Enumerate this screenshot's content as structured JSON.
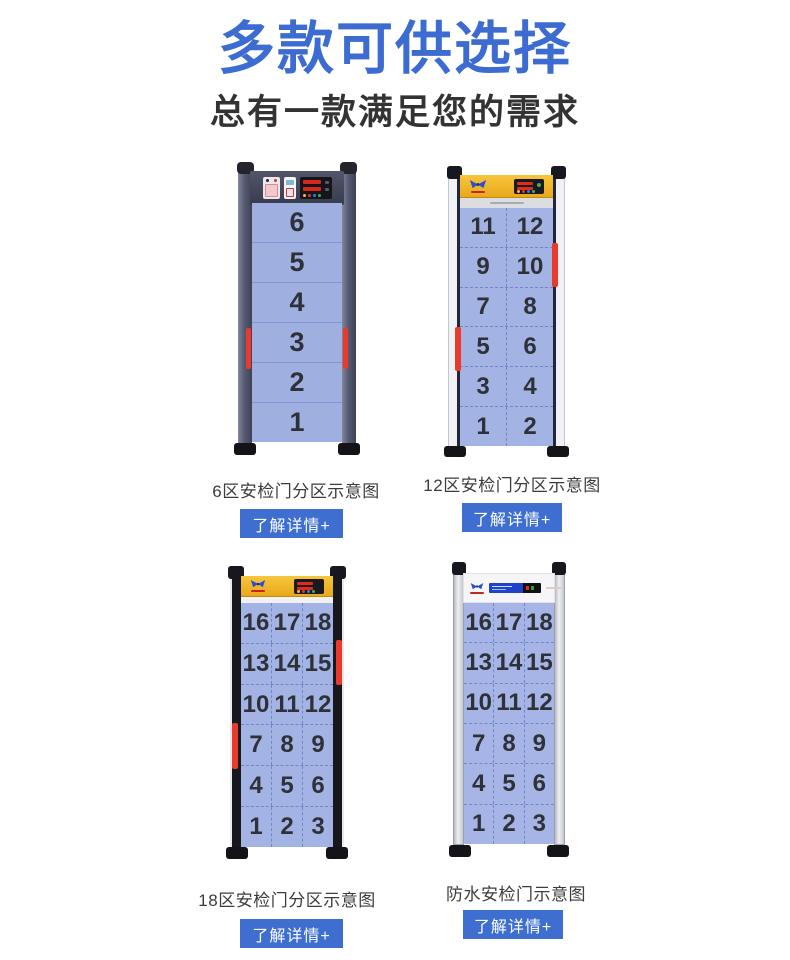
{
  "header": {
    "title": "多款可供选择",
    "subtitle": "总有一款满足您的需求"
  },
  "colors": {
    "accent_blue": "#3c6bd2",
    "button_blue": "#3e6fd0",
    "panel_blue": "#a3b3e4",
    "alarm_red": "#e93a2c",
    "header_yellow": "#eeb224"
  },
  "products": [
    {
      "id": "6-zone",
      "caption": "6区安检门分区示意图",
      "button_label": "了解详情+",
      "zone_rows": [
        [
          "6"
        ],
        [
          "5"
        ],
        [
          "4"
        ],
        [
          "3"
        ],
        [
          "2"
        ],
        [
          "1"
        ]
      ]
    },
    {
      "id": "12-zone",
      "caption": "12区安检门分区示意图",
      "button_label": "了解详情+",
      "zone_rows": [
        [
          "11",
          "12"
        ],
        [
          "9",
          "10"
        ],
        [
          "7",
          "8"
        ],
        [
          "5",
          "6"
        ],
        [
          "3",
          "4"
        ],
        [
          "1",
          "2"
        ]
      ]
    },
    {
      "id": "18-zone",
      "caption": "18区安检门分区示意图",
      "button_label": "了解详情+",
      "zone_rows": [
        [
          "16",
          "17",
          "18"
        ],
        [
          "13",
          "14",
          "15"
        ],
        [
          "10",
          "11",
          "12"
        ],
        [
          "7",
          "8",
          "9"
        ],
        [
          "4",
          "5",
          "6"
        ],
        [
          "1",
          "2",
          "3"
        ]
      ]
    },
    {
      "id": "waterproof",
      "caption": "防水安检门示意图",
      "button_label": "了解详情+",
      "zone_rows": [
        [
          "16",
          "17",
          "18"
        ],
        [
          "13",
          "14",
          "15"
        ],
        [
          "10",
          "11",
          "12"
        ],
        [
          "7",
          "8",
          "9"
        ],
        [
          "4",
          "5",
          "6"
        ],
        [
          "1",
          "2",
          "3"
        ]
      ]
    }
  ]
}
